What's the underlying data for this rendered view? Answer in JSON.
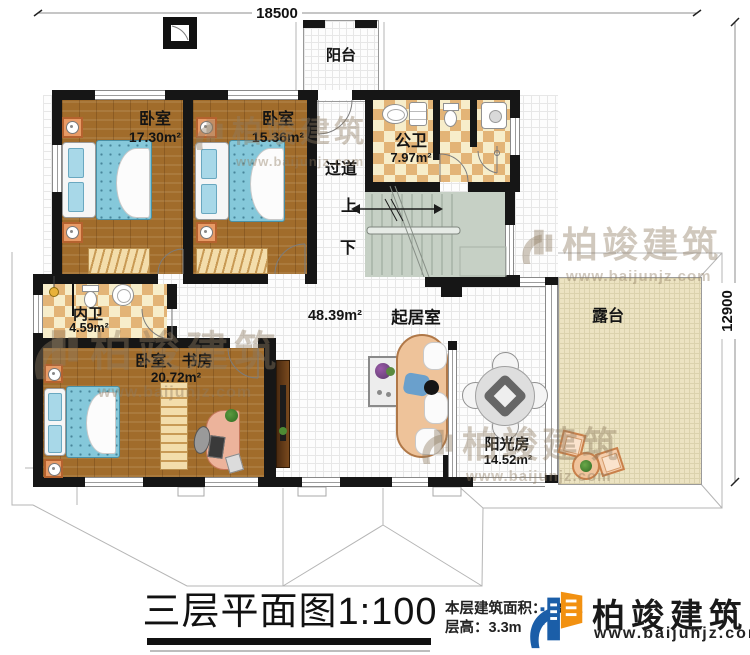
{
  "dimensions": {
    "width_label": "18500",
    "height_label": "12900"
  },
  "rooms": {
    "balcony": {
      "name": "阳台"
    },
    "bedroom1": {
      "name": "卧室",
      "area": "17.30m²"
    },
    "bedroom2": {
      "name": "卧室",
      "area": "15.36m²"
    },
    "public_bathroom": {
      "name": "公卫",
      "area": "7.97m²"
    },
    "hallway": {
      "name": "过道"
    },
    "stairs": {
      "up": "上",
      "down": "下"
    },
    "inner_bathroom": {
      "name": "内卫",
      "area": "4.59m²"
    },
    "bedroom_study": {
      "name": "卧室、书房",
      "area": "20.72m²"
    },
    "living_room": {
      "name": "起居室",
      "area": "48.39m²"
    },
    "sunroom": {
      "name": "阳光房",
      "area": "14.52m²"
    },
    "terrace": {
      "name": "露台"
    }
  },
  "footer": {
    "title": "三层平面图1:100",
    "area_label": "本层建筑面积：",
    "area_value": "137.2",
    "floor_height": "层高：3.3m",
    "brand": "柏竣建筑",
    "website": "www.baijunjz.com"
  },
  "watermark": {
    "brand": "柏竣建筑",
    "website": "www.baijunjz.com"
  },
  "colors": {
    "wall": "#161616",
    "wood": "#a16c2b",
    "checker_tile": "#e3b477",
    "stairs": "#c6d0c5",
    "terrace": "#ece3c2",
    "bed": "#85c8da",
    "brand_blue": "#1b5ea8",
    "brand_orange": "#f29111"
  }
}
